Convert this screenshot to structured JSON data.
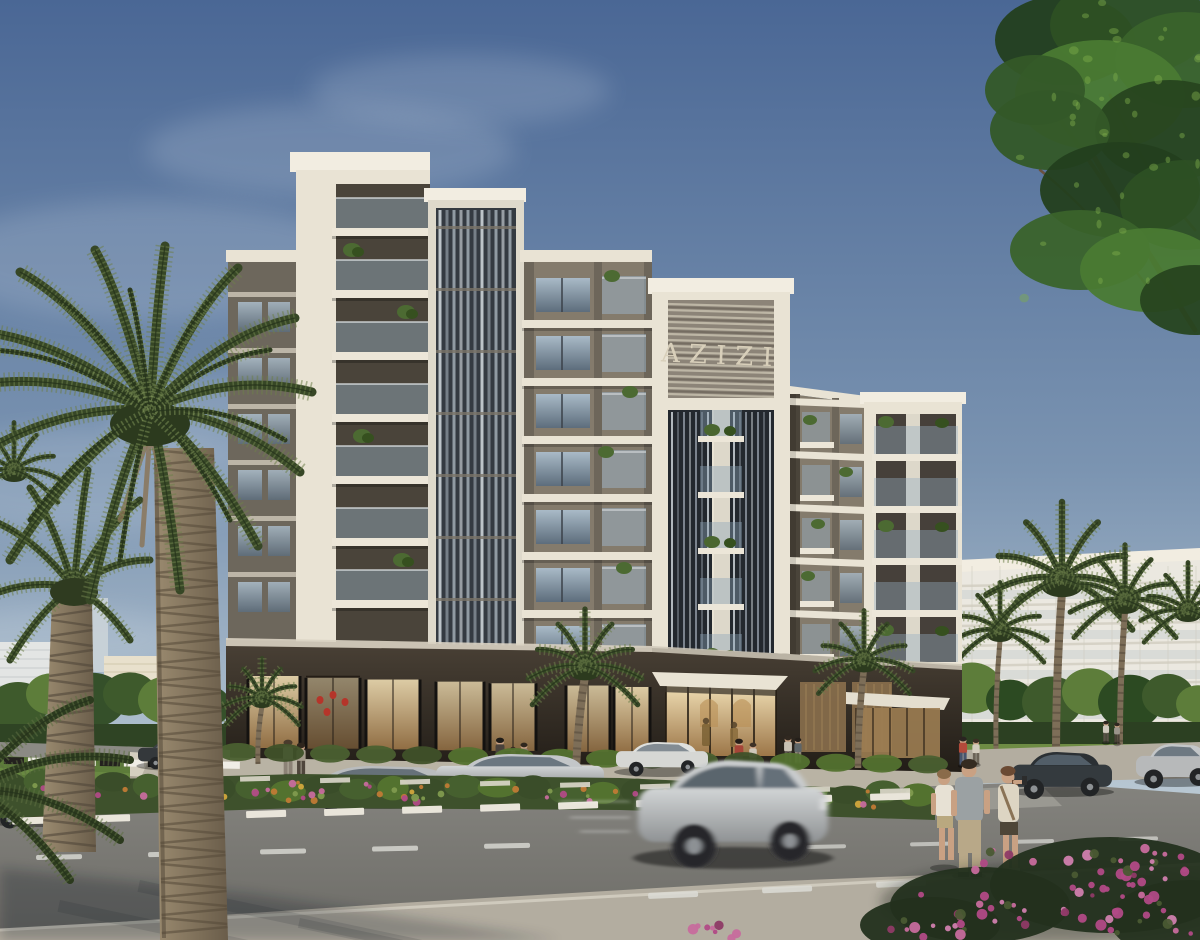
{
  "scene": {
    "logo_text": "AZIZI",
    "subject": "residential building rendering",
    "time_of_day": "day"
  },
  "colors": {
    "sky_top": "#4a6795",
    "sky_mid": "#7b94b1",
    "sky_horizon": "#b9c8d3",
    "sky_base": "#cdd7dd",
    "cloud": "#e6edf3",
    "frame_white": "#e9e3d4",
    "frame_bright": "#f2ede1",
    "stone_dark": "#6d665a",
    "stone_mid": "#847b6c",
    "stone_shadow": "#4a443a",
    "glass_light": "#a9bac7",
    "glass_dark": "#5d6d7c",
    "glass_deep": "#23282e",
    "fin_light": "#ccd3d8",
    "podium_top": "#4a4136",
    "podium_dark": "#221d17",
    "warm_glow": "#eedcb2",
    "warm_deep": "#9c7648",
    "logo_gold": "#d8cfba",
    "palm_dark": "#374726",
    "palm_light": "#6d7f4b",
    "trunk_light": "#9b8b70",
    "trunk_dark": "#6a5d4a",
    "tree_green": "#3e5a2c",
    "tree_light": "#5d7d3a",
    "lawn": "#5d7c3a",
    "road_top": "#84837e",
    "road_bottom": "#6e6d68",
    "sidewalk": "#b3ada0",
    "walkway": "#b9b3a4",
    "curb_white": "#e9e5da",
    "marking": "#dcdcd6",
    "car_silver": "#b7b9ba",
    "car_dark": "#343a3e",
    "car_maroon": "#5c2b28",
    "flower_magenta": "#b14a86",
    "flower_pink": "#c76b9d",
    "flower_yellow": "#d1a63c",
    "flower_orange": "#c07a35",
    "shrub_green": "#3e512c",
    "skin": "#c9a183"
  }
}
